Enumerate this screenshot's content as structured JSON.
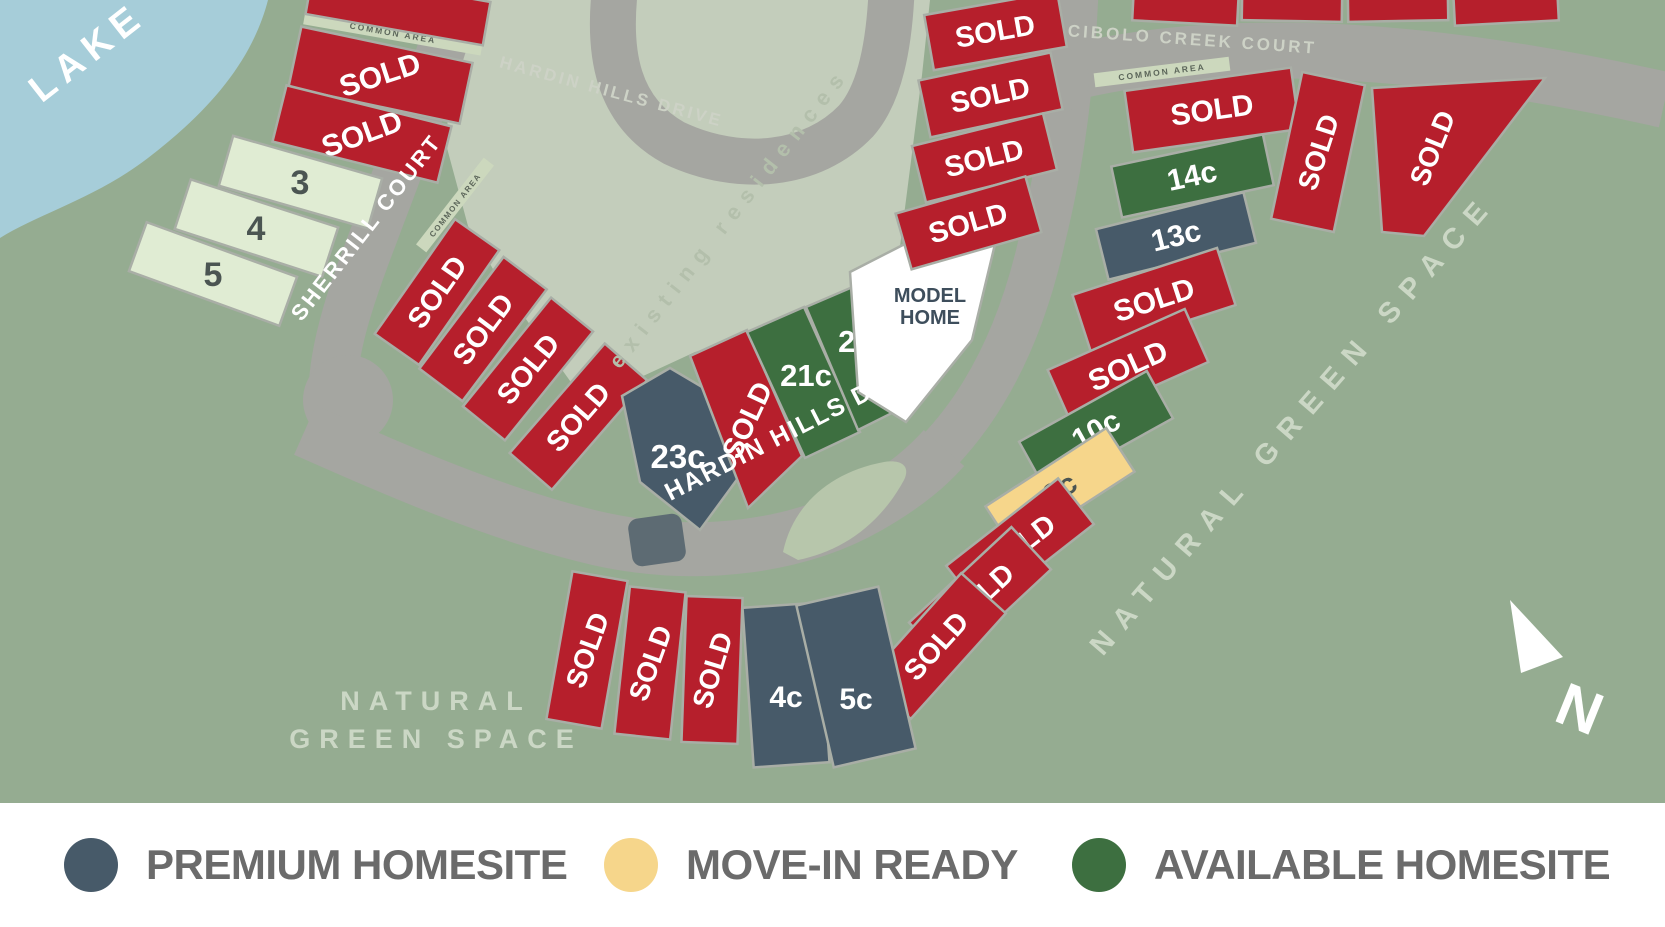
{
  "map": {
    "colors": {
      "background": "#95ac91",
      "lake": "#a6cdd9",
      "existing_area": "#c3cdbb",
      "road": "#a5a6a1",
      "median": "#b7c6ab",
      "island": "#5d6b73",
      "common_strip": "#ccd8bd",
      "common_text": "#5c665a",
      "lot_sold": "#b61f2c",
      "lot_available": "#3d6f40",
      "lot_premium": "#475a69",
      "lot_move_in": "#f6d68b",
      "lot_plain": "#e0ecd3",
      "lot_model": "#ffffff",
      "lot_stroke": "#a9aea6",
      "sold_text": "#ffffff",
      "plain_text": "#4b5552",
      "model_text": "#3e4e5c",
      "street_white": "#ffffff",
      "street_muted": "#cdd2c6",
      "green_space_text": "#cbd7c5",
      "existing_text": "#b3bfab",
      "legend_text": "#6b6b6b",
      "compass": "#ffffff"
    },
    "areas": {
      "lake": "LAKE",
      "existing_residences": "existing residences",
      "green_space_left_line1": "NATURAL",
      "green_space_left_line2": "GREEN SPACE",
      "green_space_right": "NATURAL GREEN SPACE",
      "common_area": "COMMON AREA",
      "north": "N"
    },
    "streets": {
      "hardin_top": "HARDIN HILLS DRIVE",
      "sherrill": "SHERRILL COURT",
      "cibolo": "CIBOLO CREEK COURT",
      "hardin_lower": "HARDIN HILLS DRIVE"
    },
    "model_home": {
      "line1": "MODEL",
      "line2": "HOME",
      "status": "model"
    },
    "lots": [
      {
        "label": "",
        "status": "sold"
      },
      {
        "label": "SOLD",
        "status": "sold"
      },
      {
        "label": "SOLD",
        "status": "sold"
      },
      {
        "label": "3",
        "status": "plain"
      },
      {
        "label": "4",
        "status": "plain"
      },
      {
        "label": "5",
        "status": "plain"
      },
      {
        "label": "SOLD",
        "status": "sold"
      },
      {
        "label": "SOLD",
        "status": "sold"
      },
      {
        "label": "SOLD",
        "status": "sold"
      },
      {
        "label": "SOLD",
        "status": "sold"
      },
      {
        "label": "23c",
        "status": "premium"
      },
      {
        "label": "SOLD",
        "status": "sold"
      },
      {
        "label": "21c",
        "status": "available"
      },
      {
        "label": "20c",
        "status": "available"
      },
      {
        "label": "SOLD",
        "status": "sold"
      },
      {
        "label": "SOLD",
        "status": "sold"
      },
      {
        "label": "SOLD",
        "status": "sold"
      },
      {
        "label": "SOLD",
        "status": "sold"
      },
      {
        "label": "SOLD",
        "status": "sold"
      },
      {
        "label": "14c",
        "status": "available"
      },
      {
        "label": "13c",
        "status": "premium"
      },
      {
        "label": "SOLD",
        "status": "sold"
      },
      {
        "label": "SOLD",
        "status": "sold"
      },
      {
        "label": "10c",
        "status": "available"
      },
      {
        "label": "9c",
        "status": "move_in"
      },
      {
        "label": "SOLD",
        "status": "sold"
      },
      {
        "label": "SOLD",
        "status": "sold"
      },
      {
        "label": "SOLD",
        "status": "sold"
      },
      {
        "label": "SOLD",
        "status": "sold"
      },
      {
        "label": "SOLD",
        "status": "sold"
      },
      {
        "label": "",
        "status": "sold"
      },
      {
        "label": "",
        "status": "sold"
      },
      {
        "label": "",
        "status": "sold"
      },
      {
        "label": "",
        "status": "sold"
      },
      {
        "label": "SOLD",
        "status": "sold"
      },
      {
        "label": "SOLD",
        "status": "sold"
      },
      {
        "label": "SOLD",
        "status": "sold"
      },
      {
        "label": "4c",
        "status": "premium"
      },
      {
        "label": "5c",
        "status": "premium"
      }
    ]
  },
  "legend": {
    "items": [
      {
        "label": "PREMIUM HOMESITE",
        "color": "#475a69",
        "status": "premium"
      },
      {
        "label": "MOVE-IN READY",
        "color": "#f6d68b",
        "status": "move_in"
      },
      {
        "label": "AVAILABLE HOMESITE",
        "color": "#3d6f40",
        "status": "available"
      }
    ]
  }
}
